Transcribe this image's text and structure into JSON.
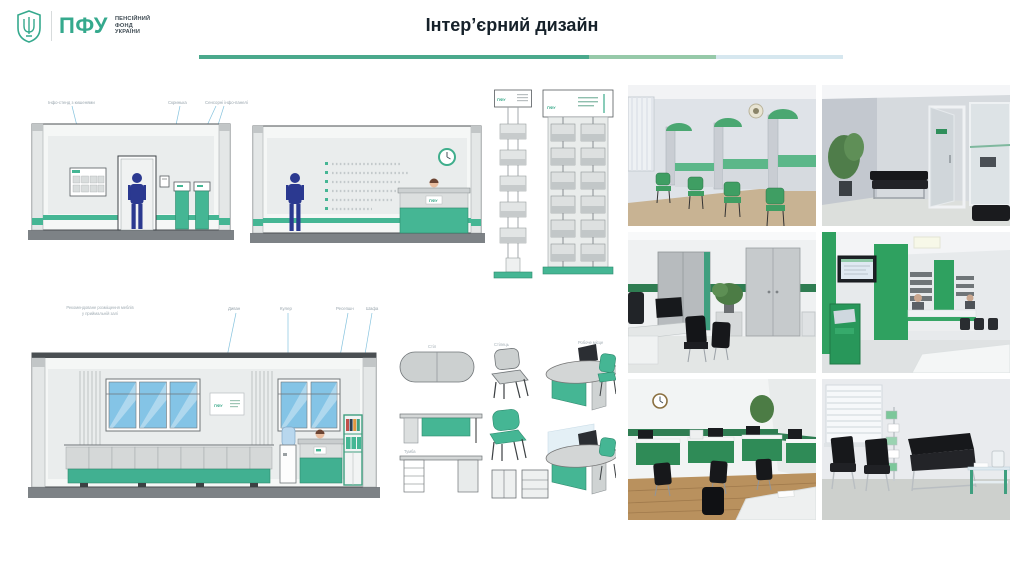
{
  "header": {
    "title": "Інтер’єрний дизайн",
    "logo": {
      "abbr": "ПФУ",
      "org_line1": "ПЕНСІЙНИЙ",
      "org_line2": "ФОНД",
      "org_line3": "УКРАЇНИ",
      "brand_green": "#35a98d"
    },
    "rule_segment_colors": [
      "#4aa98c",
      "#96c9a9",
      "#d6e7ef"
    ]
  },
  "drawings": {
    "lobby_elevation": {
      "label_info_stand": "Інфо-стенд з кишенями",
      "label_box": "Скринька",
      "label_panels": "Сенсорні інфо-панелі"
    },
    "reception_elevation": {
      "desk_sign": "ПФУ"
    },
    "brochure_stand_side": {
      "sign": "ПФУ"
    },
    "brochure_stand_front": {
      "sign": "ПФУ"
    },
    "hall_elevation": {
      "note_line1": "Рекомендоване розміщення меблів",
      "note_line2": "у приймальній залі",
      "label_sofa": "Диван",
      "label_cooler": "Кулер",
      "label_reception": "Ресепшн",
      "label_cabinet": "Шафа",
      "wall_sign": "ПФУ"
    },
    "furniture_sketches": {
      "label_table": "Стіл",
      "label_chair": "Стілець",
      "label_cabinet": "Тумба",
      "label_workstation": "Робоче місце"
    }
  },
  "palette": {
    "accent_green": "#45b694",
    "bright_photo_green": "#2fa160",
    "floor_gray": "#7d8286",
    "person_blue": "#2b3990",
    "leader_blue": "#86c3de"
  }
}
